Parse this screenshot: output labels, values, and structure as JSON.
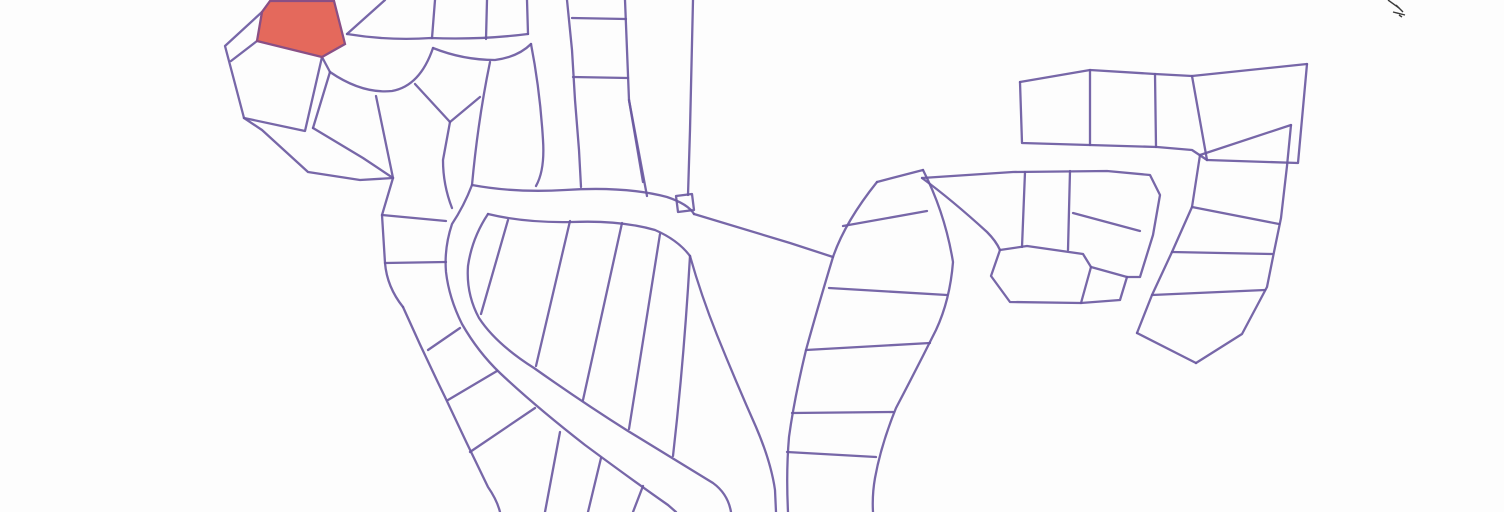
{
  "map": {
    "background": "#fdfdfd",
    "line_color": "#6b5aa1",
    "line_width": 2.3,
    "viewbox": "0 0 1504 512",
    "highlighted_parcel": {
      "fill": "#e4695c",
      "stroke": "#8a4f85",
      "d": "M270,1 L262,12 L257,41 L322,57 L345,44 L334,1 Z"
    },
    "corner_annotation": {
      "color": "#3a3a3a",
      "strokes": [
        "M1388,0 L1399,8",
        "M1396,5 L1403,12",
        "M1393,12 L1405,15",
        "M1399,15 L1402,17"
      ]
    },
    "lot_lines": [
      {
        "name": "cluster-nw-outer-west",
        "d": "M262,12 L225,46 L234,80 L244,118"
      },
      {
        "name": "cluster-nw-divider-1",
        "d": "M257,41 L231,61"
      },
      {
        "name": "cluster-nw-lot-edges",
        "d": "M244,118 L305,131 L322,57"
      },
      {
        "name": "cluster-nw-boundary-se",
        "d": "M244,118 L262,130 L308,172 L360,180 L393,178"
      },
      {
        "name": "pocket-stub",
        "d": "M322,57 L330,72"
      },
      {
        "name": "pocket-curve",
        "d": "M330,72 Q362,94 392,91 Q420,86 433,48"
      },
      {
        "name": "pocket-divider-west",
        "d": "M330,72 L313,128"
      },
      {
        "name": "pentagon-bottom",
        "d": "M313,128 L363,158 L393,178"
      },
      {
        "name": "fan-divider",
        "d": "M376,96 L393,178"
      },
      {
        "name": "pocket-divider-east",
        "d": "M415,84 L450,122"
      },
      {
        "name": "west-chain",
        "d": "M450,122 L443,160 Q443,185 452,208"
      },
      {
        "name": "road1-lower-edge",
        "d": "M433,48 Q463,60 495,60 Q518,57 531,44"
      },
      {
        "name": "road1-upper-edge",
        "d": "M347,34 Q390,41 431,38 Q480,40 528,34"
      },
      {
        "name": "top-lot-divider-1",
        "d": "M385,0 L347,34"
      },
      {
        "name": "top-lot-divider-2",
        "d": "M435,0 L432,38"
      },
      {
        "name": "top-lot-divider-3",
        "d": "M487,0 L486,39"
      },
      {
        "name": "road2-west-edge-top",
        "d": "M528,34 L527,0"
      },
      {
        "name": "road2-left-edge",
        "d": "M531,44 Q540,90 543,140 Q545,170 536,186"
      },
      {
        "name": "road2-right-edge",
        "d": "M567,0 L572,50 L575,100 L579,150 L581,187"
      },
      {
        "name": "ladder-right-edge",
        "d": "M625,0 L629,100 L643,182"
      },
      {
        "name": "ladder-rung-1",
        "d": "M572,18 L626,19"
      },
      {
        "name": "ladder-rung-2",
        "d": "M573,77 L628,78"
      },
      {
        "name": "ladder-bottom-divider",
        "d": "M629,100 L647,196"
      },
      {
        "name": "column-right-edge",
        "d": "M693,0 L690,130 L688,195"
      },
      {
        "name": "column-divider",
        "d": "M450,122 L480,97"
      },
      {
        "name": "notch-square",
        "d": "M676,196 L692,194 L694,210 L678,212 Z"
      },
      {
        "name": "hairpin-outer-edge",
        "d": "M490,62 Q478,120 472,185 Q464,206 452,224 Q444,248 446,272 Q449,298 462,324 Q478,352 500,373 Q535,406 585,445 Q635,482 668,505 L676,512"
      },
      {
        "name": "hairpin-band-top-edge",
        "d": "M472,185 Q515,193 565,190 Q625,186 667,197 Q688,204 694,214"
      },
      {
        "name": "island-north-chain",
        "d": "M488,214 Q525,223 572,222 Q620,220 655,230 Q678,240 690,256"
      },
      {
        "name": "hairpin-inner-edge",
        "d": "M488,214 Q472,238 468,266 Q466,294 479,318 Q496,344 534,368 Q582,402 628,431 Q672,458 713,483 Q728,494 731,512"
      },
      {
        "name": "island-divider-1",
        "d": "M508,220 L481,314"
      },
      {
        "name": "island-divider-2",
        "d": "M570,221 L536,366"
      },
      {
        "name": "island-divider-3",
        "d": "M622,223 L583,400"
      },
      {
        "name": "island-divider-4",
        "d": "M660,234 L629,429"
      },
      {
        "name": "island-east-divider",
        "d": "M690,256 Q684,360 673,456"
      },
      {
        "name": "fork-road-north-edge",
        "d": "M694,214 Q740,228 790,243 L833,257"
      },
      {
        "name": "island-east-chain",
        "d": "M690,256 Q701,295 717,335 Q736,382 756,427 Q771,462 775,490 L776,512"
      },
      {
        "name": "sband-left-chain",
        "d": "M877,182 Q845,222 833,257 Q817,310 806,350 Q794,400 789,437 Q786,472 788,512"
      },
      {
        "name": "sband-top-edge",
        "d": "M877,182 L923,170"
      },
      {
        "name": "sband-right-chain",
        "d": "M923,170 Q945,213 953,262 Q950,300 936,330 Q916,370 896,408 Q881,445 875,478 Q872,495 873,512"
      },
      {
        "name": "sband-rung-1",
        "d": "M843,226 L927,211"
      },
      {
        "name": "sband-rung-2",
        "d": "M829,288 L947,295"
      },
      {
        "name": "sband-rung-3",
        "d": "M806,350 L930,343"
      },
      {
        "name": "sband-rung-4",
        "d": "M792,413 L893,412"
      },
      {
        "name": "sband-rung-5",
        "d": "M787,452 L876,457"
      },
      {
        "name": "corridor-edge",
        "d": "M922,178 Q952,200 987,232 Q996,241 1000,250"
      },
      {
        "name": "cluster-mid-right-outline",
        "d": "M922,178 L1013,172 L1107,171 L1150,175 L1160,195 L1153,235 L1140,277 L1127,277"
      },
      {
        "name": "cluster-mid-right-divider-1",
        "d": "M1025,172 L1022,247"
      },
      {
        "name": "cluster-mid-right-divider-2",
        "d": "M1070,171 L1068,250"
      },
      {
        "name": "cluster-mid-right-divider-3",
        "d": "M1073,213 L1140,231"
      },
      {
        "name": "hexagon-lot",
        "d": "M1000,250 L1027,246 L1083,254 L1091,267 L1081,303 L1010,302 L991,276 Z"
      },
      {
        "name": "hexagon-appendage-1",
        "d": "M1091,267 L1127,277"
      },
      {
        "name": "hexagon-appendage-2",
        "d": "M1127,277 L1120,300 L1081,303"
      },
      {
        "name": "cluster-ne-top-edge",
        "d": "M1020,82 L1090,70 L1155,74 L1192,76 L1307,64"
      },
      {
        "name": "cluster-ne-left-bottom",
        "d": "M1020,82 L1022,143 L1157,147 L1192,150 L1207,160"
      },
      {
        "name": "cluster-ne-divider-1",
        "d": "M1090,70 L1090,145"
      },
      {
        "name": "cluster-ne-divider-2",
        "d": "M1155,74 L1156,147"
      },
      {
        "name": "cluster-ne-divider-3",
        "d": "M1192,76 L1207,160"
      },
      {
        "name": "cluster-ne-wedge",
        "d": "M1307,64 L1298,163 L1207,160"
      },
      {
        "name": "strip-far-right-top",
        "d": "M1200,155 L1291,125"
      },
      {
        "name": "strip-far-right-left-chain",
        "d": "M1200,155 L1192,207 L1172,252 L1152,295 L1137,333"
      },
      {
        "name": "strip-far-right-bottom",
        "d": "M1137,333 L1196,363"
      },
      {
        "name": "strip-far-right-right-chain",
        "d": "M1196,363 L1242,334 L1267,287 L1274,252 L1281,218 L1287,166 L1291,125"
      },
      {
        "name": "strip-rung-1",
        "d": "M1192,207 L1279,224"
      },
      {
        "name": "strip-rung-2",
        "d": "M1172,252 L1272,254"
      },
      {
        "name": "strip-rung-3",
        "d": "M1152,295 L1265,290"
      },
      {
        "name": "fan-chain-south",
        "d": "M393,178 L382,215 L385,263 Q387,287 403,307"
      },
      {
        "name": "outside-divider-1",
        "d": "M382,215 L446,221"
      },
      {
        "name": "outside-divider-2",
        "d": "M385,263 L446,262"
      },
      {
        "name": "southwest-boundary",
        "d": "M403,307 Q423,352 445,397 Q466,442 488,487 Q497,500 500,512"
      },
      {
        "name": "outside-divider-3",
        "d": "M428,350 L460,328"
      },
      {
        "name": "outside-divider-4",
        "d": "M448,400 L497,371"
      },
      {
        "name": "outside-divider-5",
        "d": "M470,452 L535,408"
      },
      {
        "name": "bottom-divider-1",
        "d": "M545,512 L560,432"
      },
      {
        "name": "bottom-divider-2",
        "d": "M588,512 L601,458"
      },
      {
        "name": "bottom-divider-3",
        "d": "M633,512 L643,486"
      }
    ]
  }
}
